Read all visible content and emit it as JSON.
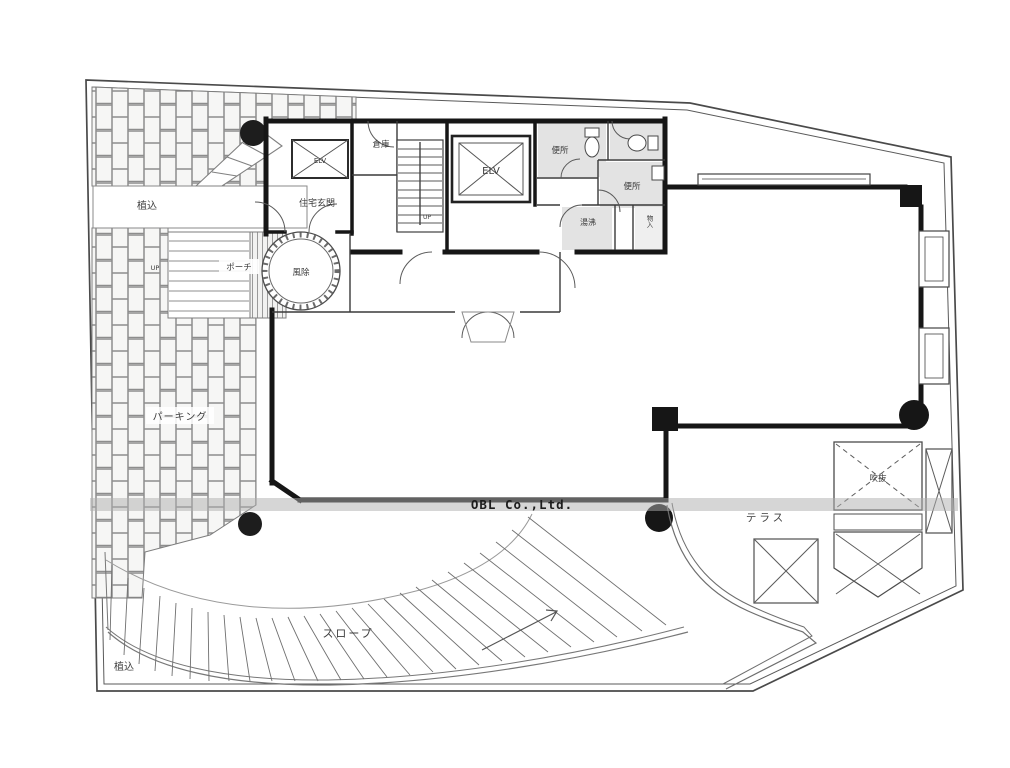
{
  "colors": {
    "ink": "#1a1a1a",
    "paper": "#ffffff"
  },
  "watermark": {
    "company": "OBL Co.,Ltd."
  },
  "labels": {
    "planting_top": "植込",
    "planting_bottom": "植込",
    "parking": "パーキング",
    "porch": "ポーチ",
    "up_outdoor": "UP",
    "up_stairs": "UP",
    "residence_entrance": "住宅玄関",
    "storage": "倉庫",
    "elevator_small": "ELV",
    "elevator_main": "ELV",
    "toilet_upper": "便所",
    "toilet_lower": "便所",
    "hot_water": "湯沸",
    "closet": "物入",
    "windbreak": "風除",
    "terrace": "テラス",
    "void_opening": "吹抜",
    "slope": "スロープ"
  }
}
